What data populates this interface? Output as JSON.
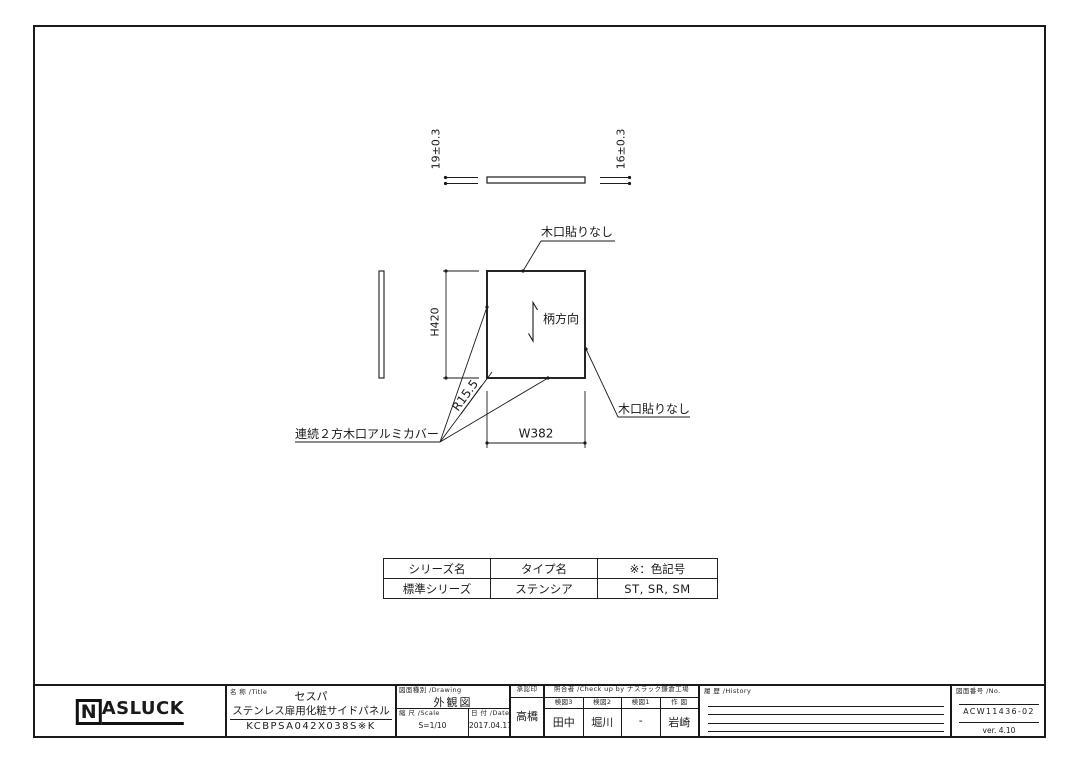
{
  "colors": {
    "line": "#1a1a1a",
    "background": "#ffffff"
  },
  "drawing": {
    "thickness_dim_left": "19±0.3",
    "thickness_dim_right": "16±0.3",
    "height_dim": "H420",
    "width_dim": "W382",
    "radius_dim": "R15.5",
    "grain_direction_label": "柄方向",
    "edge_note_top": "木口貼りなし",
    "edge_note_right": "木口貼りなし",
    "aluminum_cover_note": "連続２方木口アルミカバー"
  },
  "spec_table": {
    "headers": [
      "シリーズ名",
      "タイプ名",
      "※：色記号"
    ],
    "row": [
      "標準シリーズ",
      "ステンシア",
      "ST, SR, SM"
    ]
  },
  "title_block": {
    "logo": {
      "boxed_letter": "N",
      "rest": "ASLUCK"
    },
    "title_label": "名 称 /Title",
    "product_series": "セスパ",
    "product_name": "ステンレス扉用化粧サイドパネル",
    "model_code": "KCBPSA042X038S※K",
    "drawing_type_label": "図面種別 /Drawing",
    "drawing_type": "外観図",
    "scale_label": "縮 尺 /Scale",
    "scale": "S=1/10",
    "date_label": "日 付 /Date",
    "date": "2017.04.17",
    "approval_label": "承認印",
    "approval_name": "高橋",
    "checkup_label": "照合者 /Check up by ナスラック鎌倉工場",
    "check_cols": [
      {
        "label": "検図3",
        "name": "田中"
      },
      {
        "label": "検図2",
        "name": "堀川"
      },
      {
        "label": "検図1",
        "name": "-"
      },
      {
        "label": "作 図",
        "name": "岩崎"
      }
    ],
    "history_label": "履 歴 /History",
    "number_label": "図面番号 /No.",
    "drawing_number": "ACW11436-02",
    "version": "ver. 4.10"
  }
}
